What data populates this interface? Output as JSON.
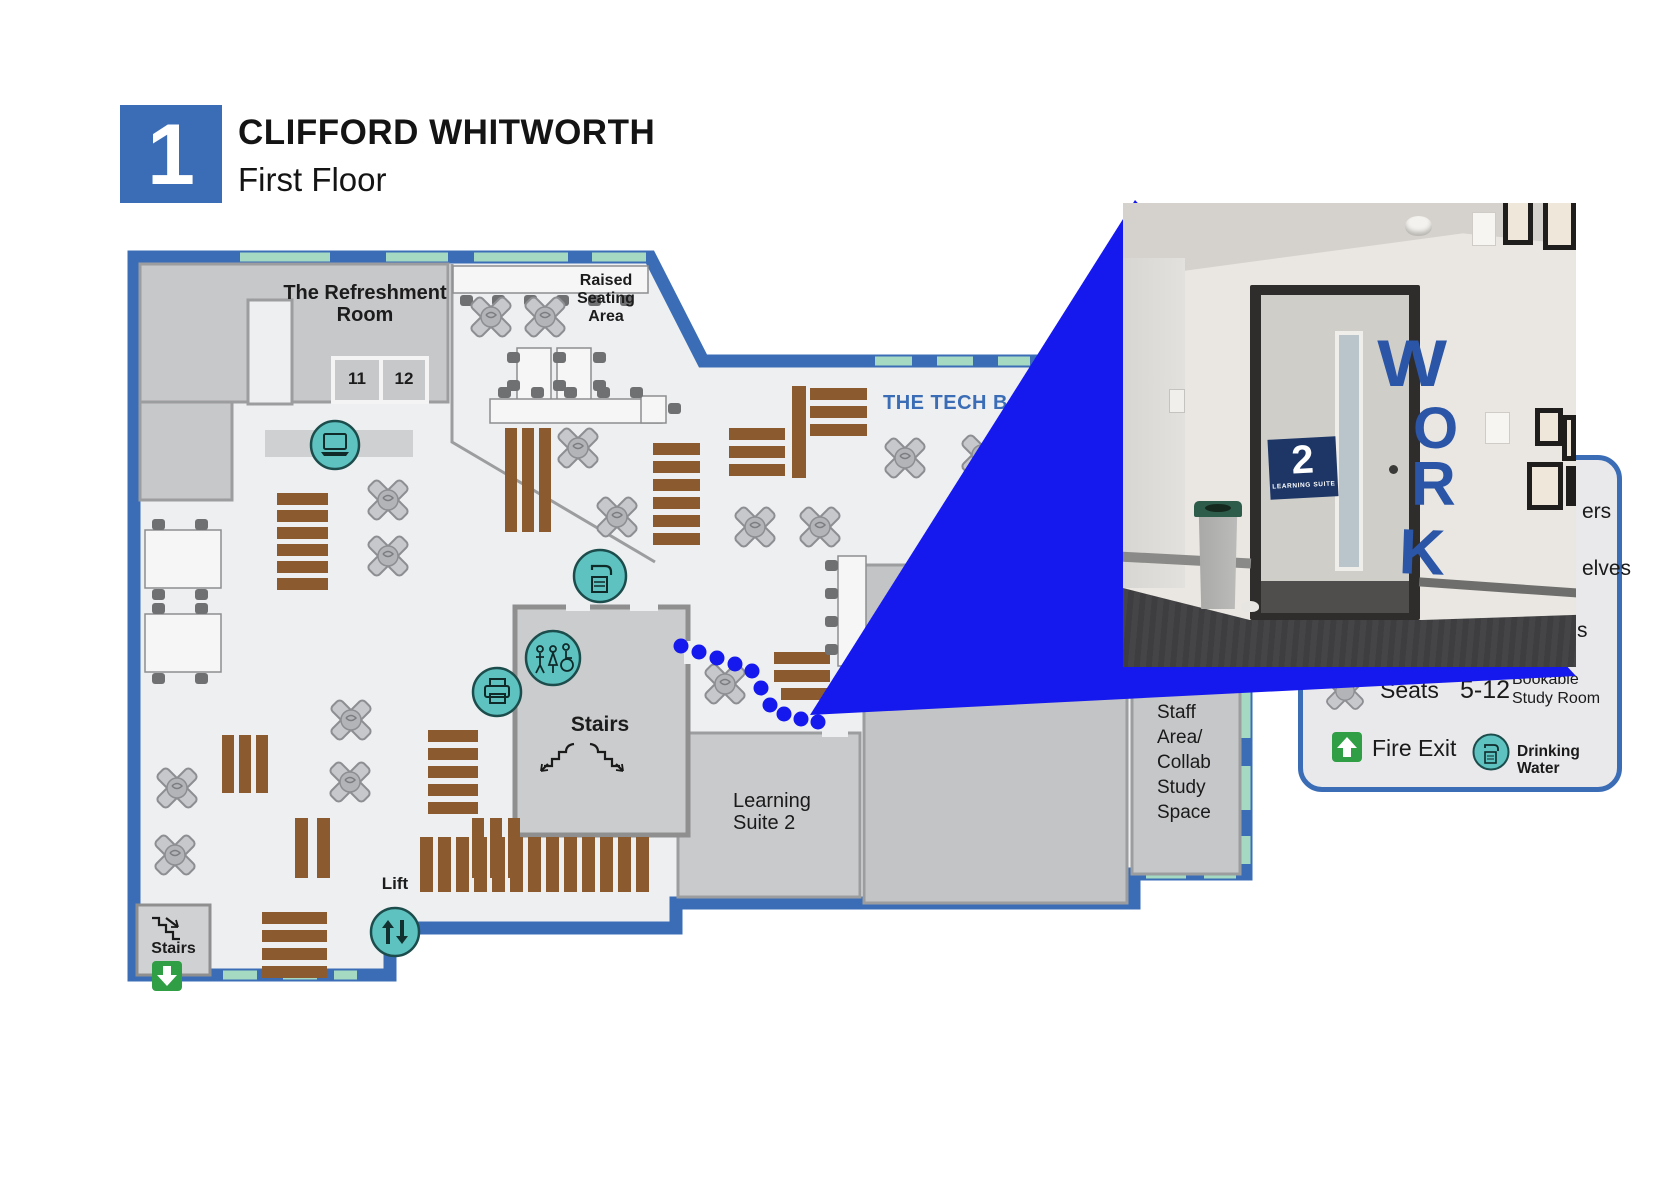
{
  "header": {
    "badge_number": "1",
    "title": "CLIFFORD WHITWORTH",
    "subtitle": "First Floor"
  },
  "map": {
    "refreshment_room": {
      "line1": "The Refreshment",
      "line2": "Room"
    },
    "room_11": "11",
    "room_12": "12",
    "raised_seating": {
      "line1": "Raised",
      "line2": "Seating",
      "line3": "Area"
    },
    "tech_bar": "THE TECH BAR",
    "stairs_center": "Stairs",
    "learning_suite": {
      "line1": "Learning",
      "line2": "Suite 2"
    },
    "staff_area": {
      "line1": "Staff",
      "line2": "Area/",
      "line3": "Collab",
      "line4": "Study",
      "line5": "Space"
    },
    "stairs_bottom": "Stairs",
    "lift": "Lift"
  },
  "legend": {
    "partial_row_1": "ers",
    "partial_row_2": "elves",
    "partial_row_3": "s",
    "seats_label": "Seats",
    "capacity_value": "5-12",
    "capacity_line1": "Bookable",
    "capacity_line2": "Study Room",
    "fire_exit_label": "Fire Exit",
    "drinking_label": "Drinking Water",
    "icons": {
      "seats": "seat-x-icon",
      "fire_exit": "fire-exit-icon",
      "drinking_water": "drinking-water-icon"
    }
  },
  "photo": {
    "sign_number": "2",
    "sign_text": "LEARNING SUITE",
    "wall_word": {
      "l1": "W",
      "l2": "O",
      "l3": "R",
      "l4": "K"
    }
  },
  "icons": [
    "laptop-icon",
    "drinking-water-icon",
    "toilets-icon",
    "printer-icon",
    "lift-icon",
    "fire-exit-icon",
    "seat-x-icon",
    "stairs-icon"
  ],
  "colors": {
    "wall_blue": "#3b6db7",
    "window_mint": "#a5d9c2",
    "route_blue": "#1519ee",
    "shelf_brown": "#8b5a2e",
    "icon_teal": "#5ec3c0",
    "fire_green": "#2f9e44",
    "work_blue": "#2b55a7",
    "sign_navy": "#1d3666"
  }
}
